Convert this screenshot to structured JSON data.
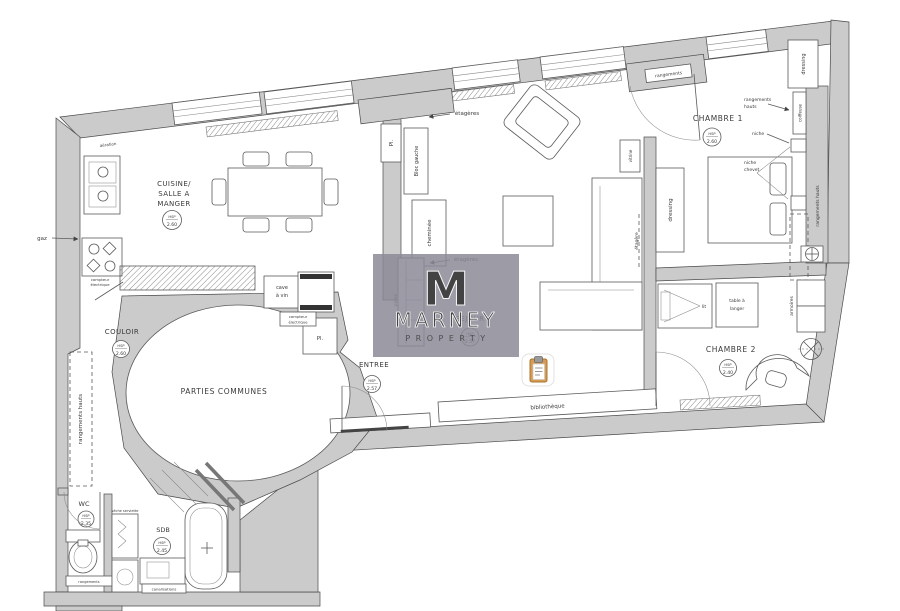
{
  "plan": {
    "hsp_label": "HSP",
    "rooms": {
      "cuisine": {
        "name1": "CUISINE/",
        "name2": "SALLE A",
        "name3": "MANGER",
        "height": "2.60"
      },
      "couloir": {
        "name": "COULOIR",
        "height": "2.60"
      },
      "parties_communes": {
        "name": "PARTIES COMMUNES"
      },
      "entree": {
        "name": "ENTREE",
        "height": "2.57"
      },
      "sejour": {
        "name": "SEJOUR",
        "height": "2.57"
      },
      "chambre1": {
        "name": "CHAMBRE 1",
        "height": "2.60"
      },
      "chambre2": {
        "name": "CHAMBRE 2",
        "height": "2.40"
      },
      "wc": {
        "name": "WC",
        "height": "2.35"
      },
      "sdb": {
        "name": "SDB",
        "height": "2.45"
      }
    },
    "annotations": {
      "aeration": "aération",
      "gaz": "gaz",
      "etageres": "étagères",
      "pl": "Pl.",
      "bloc_gauche": "Bloc gauche",
      "cheminee": "cheminée",
      "cave1": "cave",
      "cave2": "à vin",
      "compteur1": "compteur",
      "compteur2": "électrique",
      "rangements_hauts": "rangements hauts",
      "rangements1": "rangements",
      "rangements2": "hauts",
      "rangements": "rangements",
      "dressing": "dressing",
      "coiffeuse": "coiffeuse",
      "niche": "niche",
      "niche_chevet1": "niche",
      "niche_chevet2": "chevet",
      "vitrine": "vitrine",
      "etagere": "étagère",
      "bibliotheque": "bibliothèque",
      "lit": "lit",
      "table_langer1": "table à",
      "table_langer2": "langer",
      "armoires": "armoires",
      "seche_serviette": "sèche serviette",
      "canalisations": "canalisations",
      "piano": "piano"
    },
    "watermark": {
      "letter": "M",
      "name": "MARNEY",
      "subtitle": "PROPERTY"
    },
    "colors": {
      "wall": "#cbcbcb",
      "line": "#4a4a4a",
      "watermark_bg": "#8b8a96",
      "clipboard_body": "#d79b52"
    }
  }
}
